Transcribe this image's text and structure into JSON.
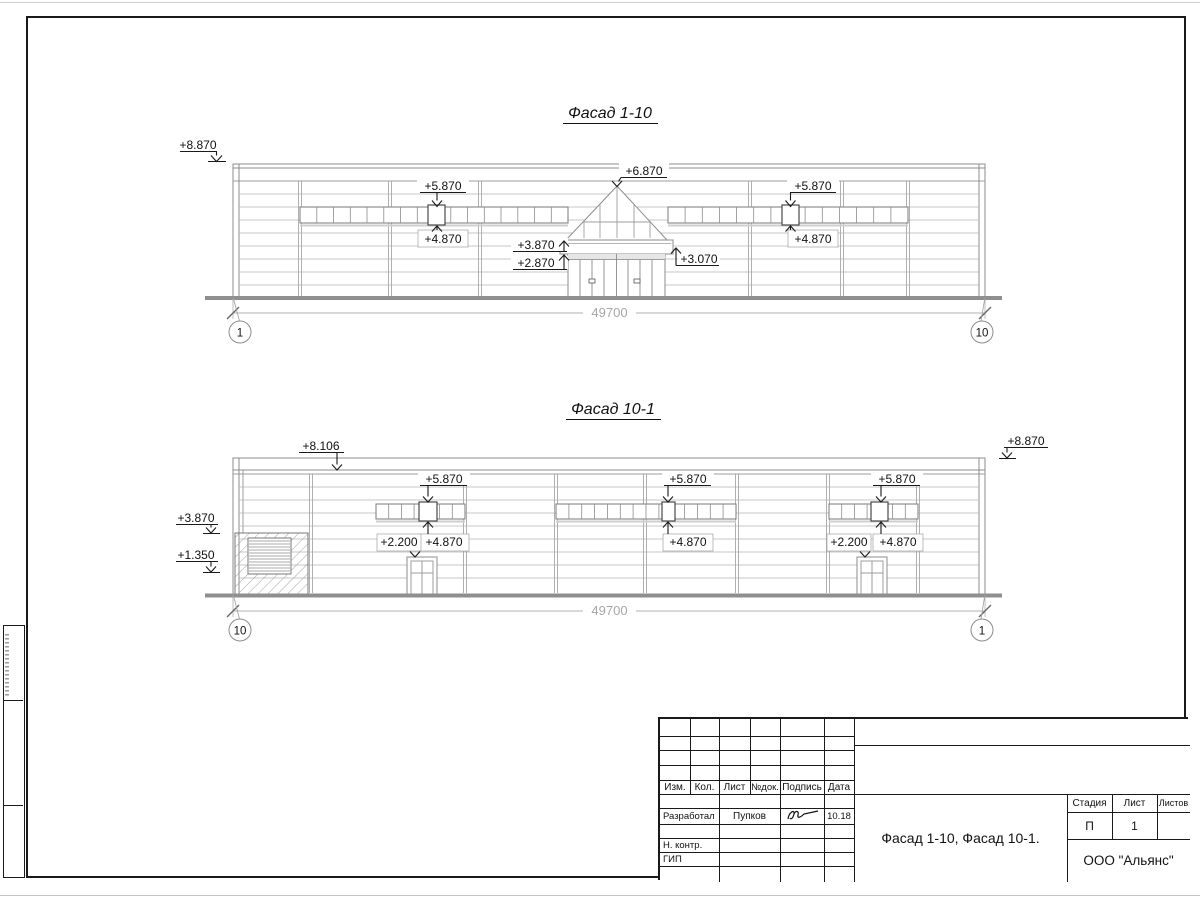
{
  "facade1": {
    "title": "Фасад 1-10",
    "dim": "49700",
    "axis_left": "1",
    "axis_right": "10",
    "marks": {
      "top_left": "+8.870",
      "win_left_top": "+5.870",
      "win_left_bottom": "+4.870",
      "apex": "+6.870",
      "canopy_upper": "+3.870",
      "canopy_lower": "+2.870",
      "canopy_right": "+3.070",
      "win_right_top": "+5.870",
      "win_right_bottom": "+4.870"
    }
  },
  "facade2": {
    "title": "Фасад 10-1",
    "dim": "49700",
    "axis_left": "10",
    "axis_right": "1",
    "marks": {
      "parapet": "+8.106",
      "top_right": "+8.870",
      "wall_left": "+3.870",
      "louver": "+1.350",
      "strip1_top": "+5.870",
      "strip1_bottom": "+4.870",
      "door1": "+2.200",
      "strip2_top": "+5.870",
      "strip2_bottom": "+4.870",
      "strip3_top": "+5.870",
      "strip3_bottom": "+4.870",
      "door2": "+2.200"
    }
  },
  "title_block": {
    "col_izm": "Изм.",
    "col_kol": "Кол.",
    "col_list": "Лист",
    "col_ndok": "№док.",
    "col_podpis": "Подпись",
    "col_data": "Дата",
    "row_razrabotal": "Разработал",
    "razrabotal_name": "Пупков",
    "razrabotal_date": "10.18",
    "row_nkontr": "Н. контр.",
    "row_gip": "ГИП",
    "doc_title": "Фасад 1-10, Фасад 10-1.",
    "company": "ООО \"Альянс\"",
    "col_stadiya": "Стадия",
    "col_sheet": "Лист",
    "col_sheets": "Листов",
    "stage": "П",
    "sheet_num": "1"
  }
}
